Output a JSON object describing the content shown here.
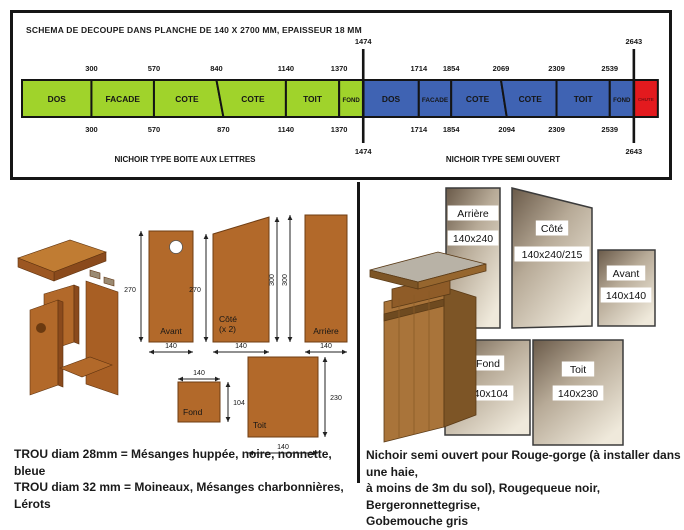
{
  "title": "SCHEMA DE DECOUPE DANS PLANCHE DE 140 X 2700 MM, EPAISSEUR 18 MM",
  "cutting_diagram": {
    "board": {
      "width_mm": 140,
      "length_mm": 2700,
      "thickness_mm": 18
    },
    "boundaries": [
      "1474",
      "2643"
    ],
    "sections": [
      {
        "name": "NICHOIR TYPE BOITE AUX LETTRES",
        "color": "#a0d32b",
        "name_x": 172,
        "segments": [
          {
            "label": "DOS",
            "top_start": 0,
            "top_end": 300,
            "bottom_start": 0,
            "bottom_end": 300
          },
          {
            "label": "FACADE",
            "top_start": 300,
            "top_end": 570,
            "bottom_start": 300,
            "bottom_end": 570
          },
          {
            "label": "COTE",
            "top_start": 570,
            "top_end": 840,
            "bottom_start": 570,
            "bottom_end": 870
          },
          {
            "label": "COTE",
            "top_start": 840,
            "top_end": 1140,
            "bottom_start": 870,
            "bottom_end": 1140
          },
          {
            "label": "TOIT",
            "top_start": 1140,
            "top_end": 1370,
            "bottom_start": 1140,
            "bottom_end": 1370
          },
          {
            "label": "FOND",
            "top_start": 1370,
            "top_end": 1474,
            "bottom_start": 1370,
            "bottom_end": 1474
          }
        ],
        "ticks_top": [
          "300",
          "570",
          "840",
          "1140",
          "1370"
        ],
        "ticks_top_mm": [
          300,
          570,
          840,
          1140,
          1370
        ],
        "ticks_bottom": [
          "300",
          "570",
          "870",
          "1140",
          "1370"
        ],
        "ticks_bottom_mm": [
          300,
          570,
          870,
          1140,
          1370
        ]
      },
      {
        "name": "NICHOIR TYPE SEMI OUVERT",
        "color": "#3f63b3",
        "name_x": 490,
        "segments": [
          {
            "label": "DOS",
            "top_start": 1474,
            "top_end": 1714,
            "bottom_start": 1474,
            "bottom_end": 1714
          },
          {
            "label": "FACADE",
            "top_start": 1714,
            "top_end": 1854,
            "bottom_start": 1714,
            "bottom_end": 1854
          },
          {
            "label": "COTE",
            "top_start": 1854,
            "top_end": 2069,
            "bottom_start": 1854,
            "bottom_end": 2094
          },
          {
            "label": "COTE",
            "top_start": 2069,
            "top_end": 2309,
            "bottom_start": 2094,
            "bottom_end": 2309
          },
          {
            "label": "TOIT",
            "top_start": 2309,
            "top_end": 2539,
            "bottom_start": 2309,
            "bottom_end": 2539
          },
          {
            "label": "FOND",
            "top_start": 2539,
            "top_end": 2643,
            "bottom_start": 2539,
            "bottom_end": 2643
          }
        ],
        "ticks_top": [
          "1714",
          "1854",
          "2069",
          "2309",
          "2539"
        ],
        "ticks_top_mm": [
          1714,
          1854,
          2069,
          2309,
          2539
        ],
        "ticks_bottom": [
          "1714",
          "1854",
          "2094",
          "2309",
          "2539"
        ],
        "ticks_bottom_mm": [
          1714,
          1854,
          2094,
          2309,
          2539
        ]
      }
    ],
    "offcut": {
      "label": "CHUTE",
      "start_mm": 2643,
      "end_mm": 2700,
      "color": "#e31a1e",
      "text_color": "#7c1014"
    }
  },
  "letterbox_plan": {
    "panels": {
      "avant": {
        "label": "Avant",
        "height_dim": "270",
        "width_dim": "140"
      },
      "cote": {
        "label": "Côté",
        "sub": "(x 2)",
        "height_dim": "270",
        "back_height_dim": "300",
        "width_dim": "140"
      },
      "arriere": {
        "label": "Arrière",
        "height_dim": "300",
        "width_dim": "140"
      },
      "fond": {
        "label": "Fond",
        "width_dim": "140",
        "depth_dim": "104"
      },
      "toit": {
        "label": "Toit",
        "width_dim": "140",
        "depth_dim": "230"
      }
    }
  },
  "semi_open_plan": {
    "panels": [
      {
        "label": "Arrière",
        "size": "140x240"
      },
      {
        "label": "Côté",
        "size": "140x240/215"
      },
      {
        "label": "Avant",
        "size": "140x140"
      },
      {
        "label": "Fond",
        "size": "140x104"
      },
      {
        "label": "Toit",
        "size": "140x230"
      }
    ]
  },
  "hole_notes": [
    "TROU diam 28mm = Mésanges huppée, noire, nonnette, bleue",
    "TROU diam 32 mm = Moineaux, Mésanges charbonnières, Lérots"
  ],
  "semi_open_note_lines": [
    "Nichoir semi ouvert pour Rouge-gorge (à installer dans une haie,",
    "à moins de 3m du sol), Rougequeue noir, Bergeronnettegrise,",
    "Gobemouche gris"
  ]
}
